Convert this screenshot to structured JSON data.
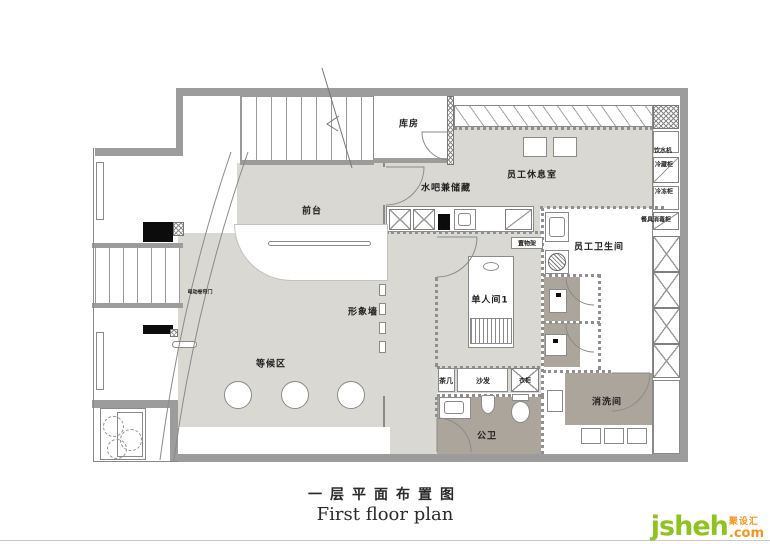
{
  "title": {
    "zh": "一层平面布置图",
    "en": "First floor plan"
  },
  "labels": {
    "storage": "库房",
    "lounge": "员工休息室",
    "water_bar": "水吧兼储藏",
    "front_desk": "前台",
    "rolling_door": "电动卷帘门",
    "feature_wall": "形象墙",
    "shelf": "置物架",
    "staff_wc": "员工卫生间",
    "single_room": "单人间1",
    "waiting": "等候区",
    "tea_table": "茶几",
    "sofa": "沙发",
    "wardrobe": "衣柜",
    "public_wc": "公卫",
    "wash_room": "消洗间",
    "water_dispenser": "饮水机",
    "fridge": "冷藏柜",
    "freezer": "冷冻柜",
    "sterilizer": "餐具消毒柜"
  },
  "logo": {
    "brand": "jsheh",
    "suffix": ".com",
    "tag": "聚设汇"
  },
  "colors": {
    "wall": "#9c9c9c",
    "floor": "#d9d8d3",
    "dark_floor": "#aba59b",
    "brand_green": "#8fc31f",
    "brand_orange": "#f7941d"
  }
}
